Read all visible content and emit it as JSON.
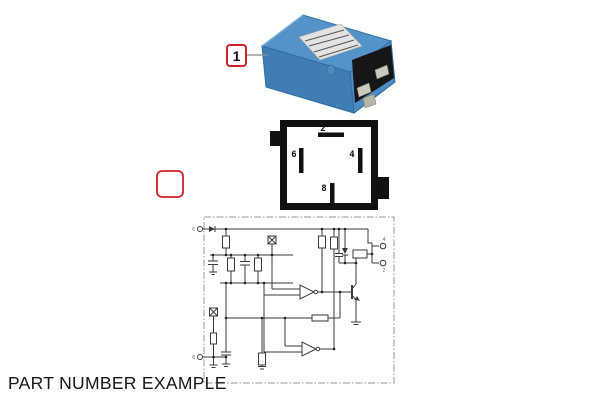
{
  "title": "PART NUMBER EXAMPLE",
  "callout": {
    "label": "1"
  },
  "empty_callout": {
    "label": ""
  },
  "pin_diagram": {
    "pins": [
      {
        "label": "2"
      },
      {
        "label": "6"
      },
      {
        "label": "4"
      },
      {
        "label": "8"
      }
    ]
  },
  "schematic": {
    "terminals": [
      {
        "label": "6"
      },
      {
        "label": "8"
      },
      {
        "label": "4"
      },
      {
        "label": "2"
      }
    ]
  },
  "colors": {
    "callout_red": "#cc2229",
    "relay_blue": "#4a8bc2",
    "relay_blue_dark": "#3f7db4",
    "relay_blue_light": "#5493ca",
    "pin_black": "#161616",
    "schematic_ink": "#3a3a3a",
    "border_gray": "#9a9a9a"
  }
}
